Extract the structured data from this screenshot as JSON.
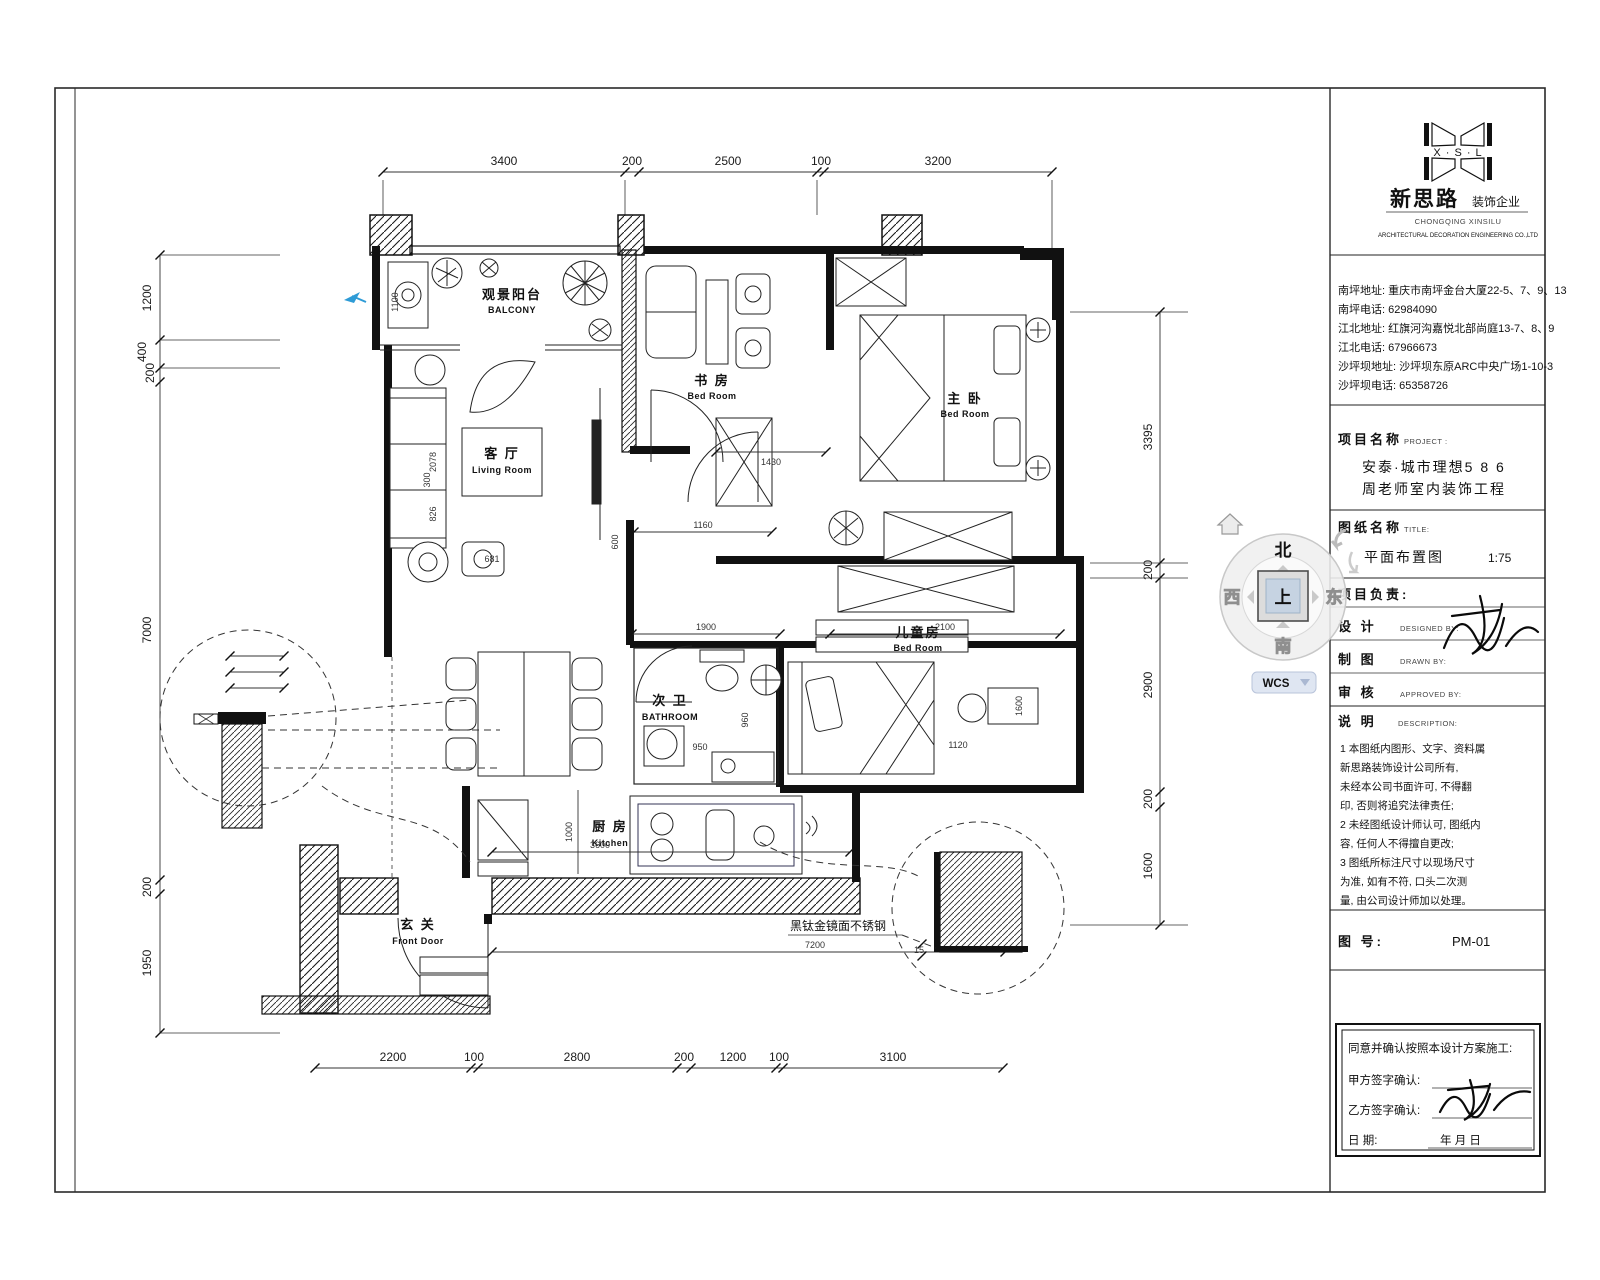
{
  "title_block": {
    "logo": {
      "initials": "X · S · L",
      "name_cn": "新思路",
      "name_tag": "装饰企业",
      "en1": "CHONGQING XINSILU",
      "en2": "ARCHITECTURAL DECORATION ENGINEERING CO.,LTD"
    },
    "contacts": {
      "lines": [
        "南坪地址: 重庆市南坪金台大厦22-5、7、9、13",
        "南坪电话: 62984090",
        "江北地址: 红旗河沟嘉悦北部尚庭13-7、8、9",
        "江北电话: 67966673",
        "沙坪坝地址: 沙坪坝东原ARC中央广场1-10-3",
        "沙坪坝电话: 65358726"
      ]
    },
    "project": {
      "label": "项目名称",
      "label_en": "PROJECT :",
      "line1": "安泰·城市理想5 8 6",
      "line2": "周老师室内装饰工程"
    },
    "sheet": {
      "label": "图纸名称",
      "label_en": "TITLE:",
      "name": "平面布置图",
      "scale": "1:75"
    },
    "roles": {
      "lead": "项目负责:",
      "design": "设  计",
      "design_en": "DESIGNED BY:",
      "draft": "制  图",
      "draft_en": "DRAWN BY:",
      "approve": "审  核",
      "approve_en": "APPROVED BY:"
    },
    "notes": {
      "label": "说  明",
      "label_en": "DESCRIPTION:",
      "lines": [
        "1 本图纸内图形、文字、资料属",
        "   新思路装饰设计公司所有,",
        "   未经本公司书面许可, 不得翻",
        "   印, 否则将追究法律责任;",
        "2 未经图纸设计师认可, 图纸内",
        "   容, 任何人不得擅自更改;",
        "3 图纸所标注尺寸以现场尺寸",
        "   为准, 如有不符, 口头二次测",
        "   量, 由公司设计师加以处理。"
      ]
    },
    "sheet_no": {
      "label": "图  号:",
      "value": "PM-01"
    },
    "confirm": {
      "title": "同意并确认按照本设计方案施工:",
      "party_a": "甲方签字确认:",
      "party_b": "乙方签字确认:",
      "date_label": "日        期:",
      "date_value": "年    月    日"
    }
  },
  "viewcube": {
    "north": "北",
    "south": "南",
    "west": "西",
    "east": "东",
    "top_face": "上",
    "wcs_label": "WCS"
  },
  "plan": {
    "rooms": [
      {
        "cn": "观景阳台",
        "en": "BALCONY"
      },
      {
        "cn": "客 厅",
        "en": "Living Room"
      },
      {
        "cn": "书 房",
        "en": "Bed Room"
      },
      {
        "cn": "主 卧",
        "en": "Bed Room"
      },
      {
        "cn": "儿童房",
        "en": "Bed Room"
      },
      {
        "cn": "次 卫",
        "en": "BATHROOM"
      },
      {
        "cn": "厨 房",
        "en": "Kitchen"
      },
      {
        "cn": "玄 关",
        "en": "Front Door"
      }
    ],
    "dims_top": [
      "3400",
      "200",
      "2500",
      "100",
      "3200"
    ],
    "dims_left": [
      "1200",
      "400",
      "200",
      "7000",
      "200",
      "1950"
    ],
    "dims_right": [
      "3395",
      "200",
      "2900",
      "200",
      "1600"
    ],
    "dims_bottom": [
      "2200",
      "100",
      "2800",
      "200",
      "1200",
      "100",
      "3100"
    ],
    "inner_dims": {
      "d1430": "1430",
      "d1160": "1160",
      "d600": "600",
      "d300": "300",
      "d1100": "1100",
      "d1900": "1900",
      "d2100": "2100",
      "d960": "960",
      "d950": "950",
      "d1120": "1120",
      "d1600": "1600",
      "d1000": "1000",
      "d3600": "3600",
      "d7200": "7200",
      "d2078": "2078",
      "d826": "826",
      "d681": "681",
      "d15": "15"
    },
    "annotations": {
      "steel": "黑钛金镜面不锈钢"
    }
  }
}
